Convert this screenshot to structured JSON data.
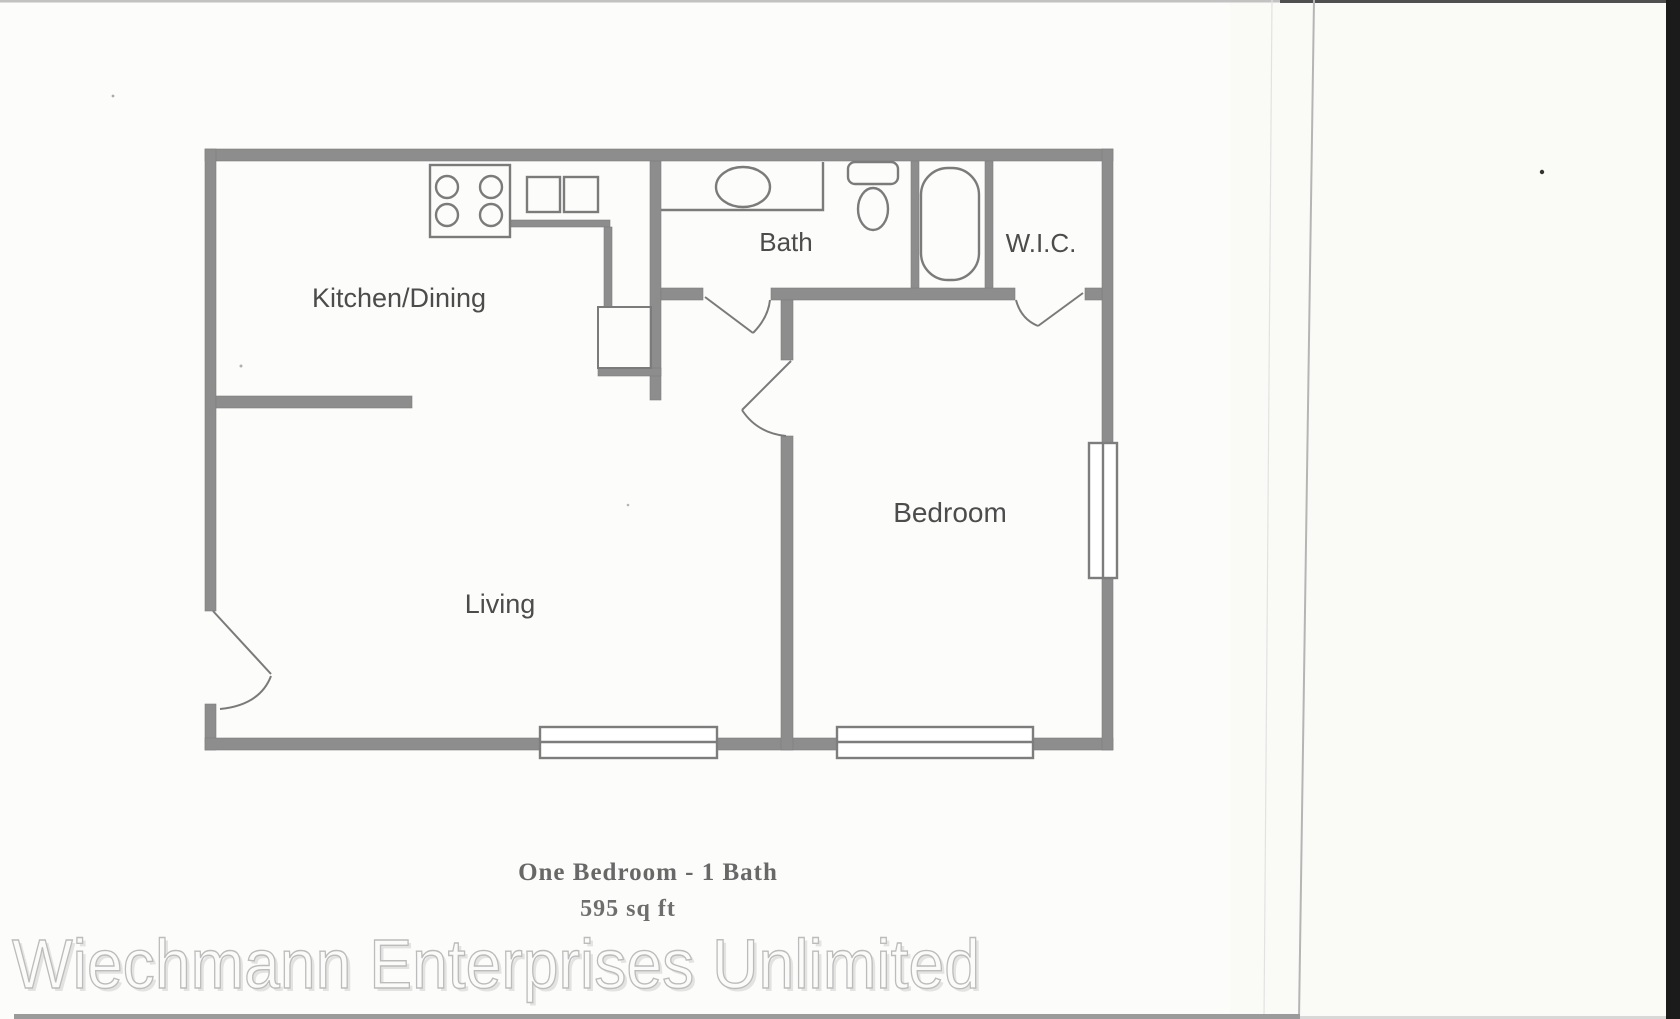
{
  "page": {
    "watermark": "Wiechmann Enterprises Unlimited"
  },
  "floor_plan": {
    "rooms": [
      {
        "name": "kitchen-dining",
        "label": "Kitchen/Dining"
      },
      {
        "name": "bath",
        "label": "Bath"
      },
      {
        "name": "walk-in-closet",
        "label": "W.I.C."
      },
      {
        "name": "bedroom",
        "label": "Bedroom"
      },
      {
        "name": "living",
        "label": "Living"
      }
    ],
    "caption": {
      "title": "One Bedroom - 1 Bath",
      "area": "595 sq ft"
    },
    "fixtures": [
      {
        "name": "stove-icon",
        "desc": "4-burner stove"
      },
      {
        "name": "kitchen-sink-icon",
        "desc": "double-basin kitchen sink"
      },
      {
        "name": "pantry-icon",
        "desc": "pantry closet box"
      },
      {
        "name": "vanity-sink-icon",
        "desc": "bathroom vanity with oval sink"
      },
      {
        "name": "toilet-icon",
        "desc": "toilet with tank"
      },
      {
        "name": "bathtub-icon",
        "desc": "bathtub"
      }
    ],
    "colors": {
      "wall": "#8d8d8d",
      "fixture_line": "#7b7b7b",
      "room_label": "#4c4c4c",
      "caption_text": "#686868",
      "watermark_outline": "#bcbcbc",
      "scan_edge": "#1b1b1b"
    }
  }
}
